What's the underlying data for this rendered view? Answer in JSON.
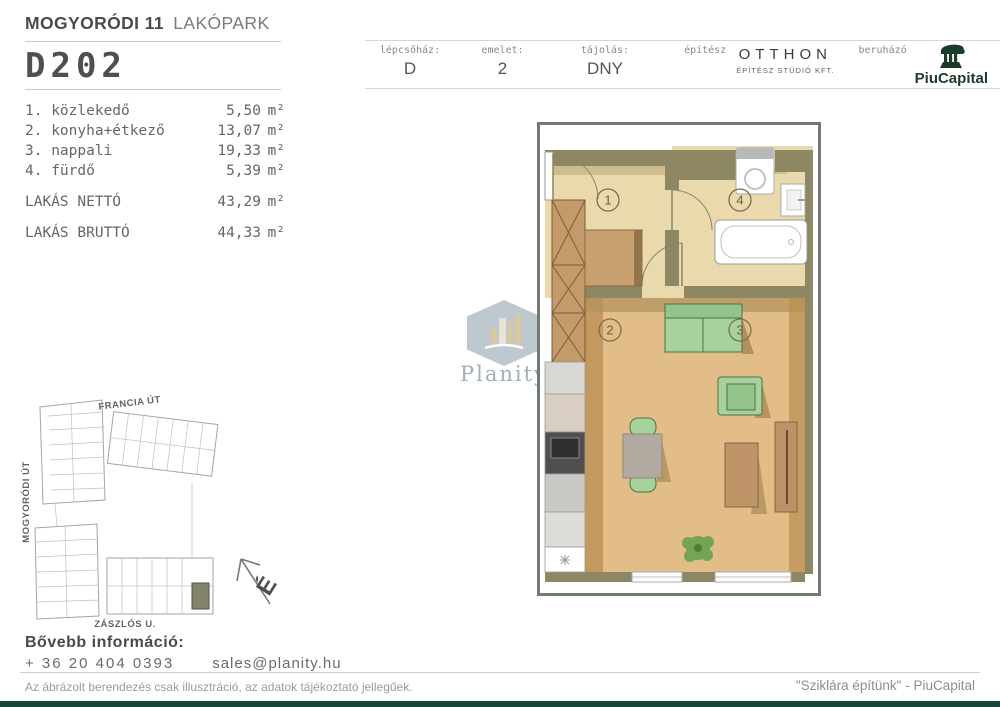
{
  "header": {
    "project_bold": "MOGYORÓDI 11",
    "project_light": "LAKÓPARK",
    "unit_id": "D202"
  },
  "info_bar": {
    "staircase": {
      "label": "lépcsőház:",
      "value": "D"
    },
    "floor": {
      "label": "emelet:",
      "value": "2"
    },
    "orientation": {
      "label": "tájolás:",
      "value": "DNY"
    },
    "architect": {
      "label": "építész",
      "name": "OTTHON",
      "subname": "ÉPÍTÉSZ STÚDIÓ KFT."
    },
    "developer": {
      "label": "beruházó",
      "brand": "PiuCapital"
    }
  },
  "room_table": {
    "rows": [
      {
        "num": "1. ",
        "name": "közlekedő",
        "area": "5,50",
        "unit": "m²"
      },
      {
        "num": "2. ",
        "name": "konyha+étkező",
        "area": "13,07",
        "unit": "m²"
      },
      {
        "num": "3. ",
        "name": "nappali",
        "area": "19,33",
        "unit": "m²"
      },
      {
        "num": "4. ",
        "name": "fürdő",
        "area": "5,39",
        "unit": "m²"
      }
    ],
    "totals": [
      {
        "label": "LAKÁS NETTÓ",
        "area": "43,29",
        "unit": "m²"
      },
      {
        "label": "LAKÁS BRUTTÓ",
        "area": "44,33",
        "unit": "m²"
      }
    ]
  },
  "floor_plan": {
    "room_numbers": {
      "r1": "1",
      "r2": "2",
      "r3": "3",
      "r4": "4"
    }
  },
  "site_plan": {
    "street_top": "FRANCIA ÚT",
    "street_left": "MOGYORÓDI ÚT",
    "street_bottom": "ZÁSZLÓS U.",
    "compass": "É"
  },
  "watermark": {
    "brand": "Planity"
  },
  "contact": {
    "heading": "Bővebb információ:",
    "phone": "+ 36 20 404 0393",
    "email": "sales@planity.hu"
  },
  "footer": {
    "disclaimer": "Az ábrázolt berendezés csak illusztráció, az adatok tájékoztató jellegűek.",
    "slogan": "\"Sziklára építünk\" - PiuCapital"
  },
  "colors": {
    "brand_green": "#1d3b2b",
    "wall_khaki": "#8d8764",
    "floor_cream": "#ead9ad",
    "floor_wood": "#e2bd87",
    "furniture_green": "#a8d29c",
    "site_highlight": "#84846c",
    "footer_bar": "#17453a"
  }
}
